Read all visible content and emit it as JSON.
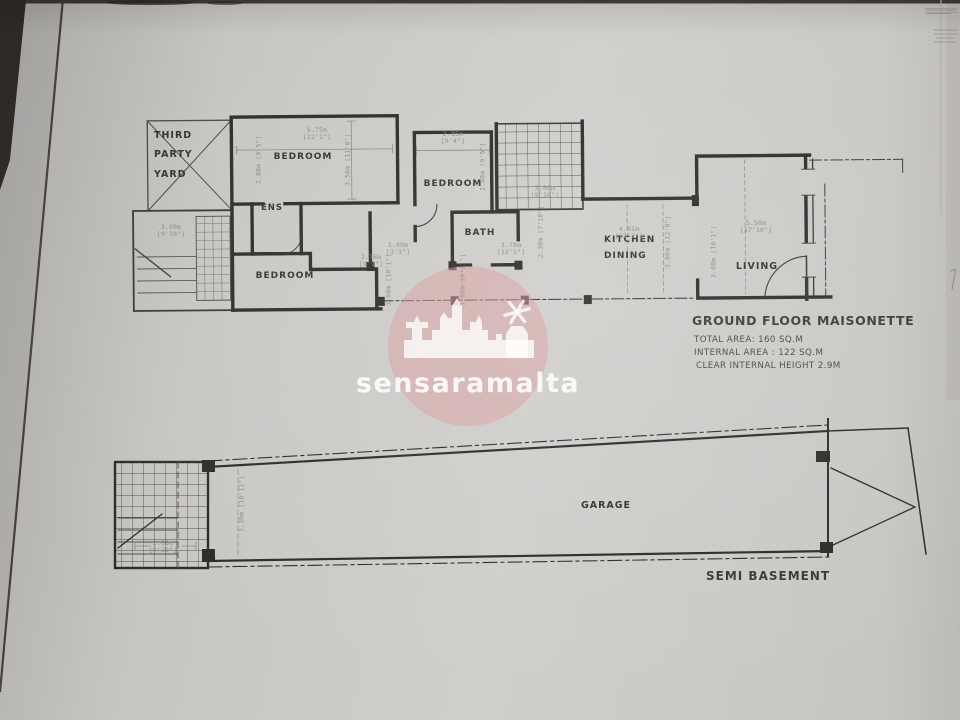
{
  "watermark": {
    "brand": "sensaramalta"
  },
  "ground_floor": {
    "title": "GROUND FLOOR MAISONETTE",
    "stats": [
      "TOTAL AREA: 160 SQ.M",
      "INTERNAL AREA : 122 SQ.M",
      "CLEAR INTERNAL HEIGHT 2.9M"
    ],
    "rooms": {
      "third_party_yard": "THIRD\nPARTY\nYARD",
      "bedroom_top": "BEDROOM",
      "bedroom_mid": "BEDROOM",
      "bedroom_bottom": "BEDROOM",
      "ens": "ENS",
      "bath": "BATH",
      "kitchen_dining": "KITCHEN\nDINING",
      "living": "LIVING"
    },
    "dims": {
      "bedroom_top_width": "6.75m\n[22'1\"]",
      "bedroom_top_depth": "3.56m [11'8\"]",
      "bedroom_top_left": "2.88m [9'5\"]",
      "bedroom_mid_width": "2.85m\n[9'4\"]",
      "bedroom_mid_depth": "2.88m [9'5\"]",
      "stairwell": "3.00m\n[9'10\"]",
      "bath_door": "1.00m\n[3'3\"]",
      "bath_width": "3.78m\n[12'5\"]",
      "kitchen_width": "4.01m\n[13'2\"]",
      "living_width": "5.50m\n[17'10\"]",
      "living_depth": "3.08m [10'1\"]",
      "left_block": "3.00m\n[9'10\"]",
      "bedroom_bottom_width": "2.76m\n[9'1\"]",
      "bedroom_bottom_depth": "3.08m [10'1\"]",
      "bath_side": "2.38m [7'10\"]",
      "kitchen_depth": "3.66m [12'0\"]",
      "terrace_depth": "3.02m [9'11\"]"
    }
  },
  "basement": {
    "title": "SEMI BASEMENT",
    "rooms": {
      "garage": "GARAGE"
    },
    "dims": {
      "garage_depth": "3.30m [10'11\"]",
      "stair_width": "3.00m\n[9'10\"]"
    }
  }
}
